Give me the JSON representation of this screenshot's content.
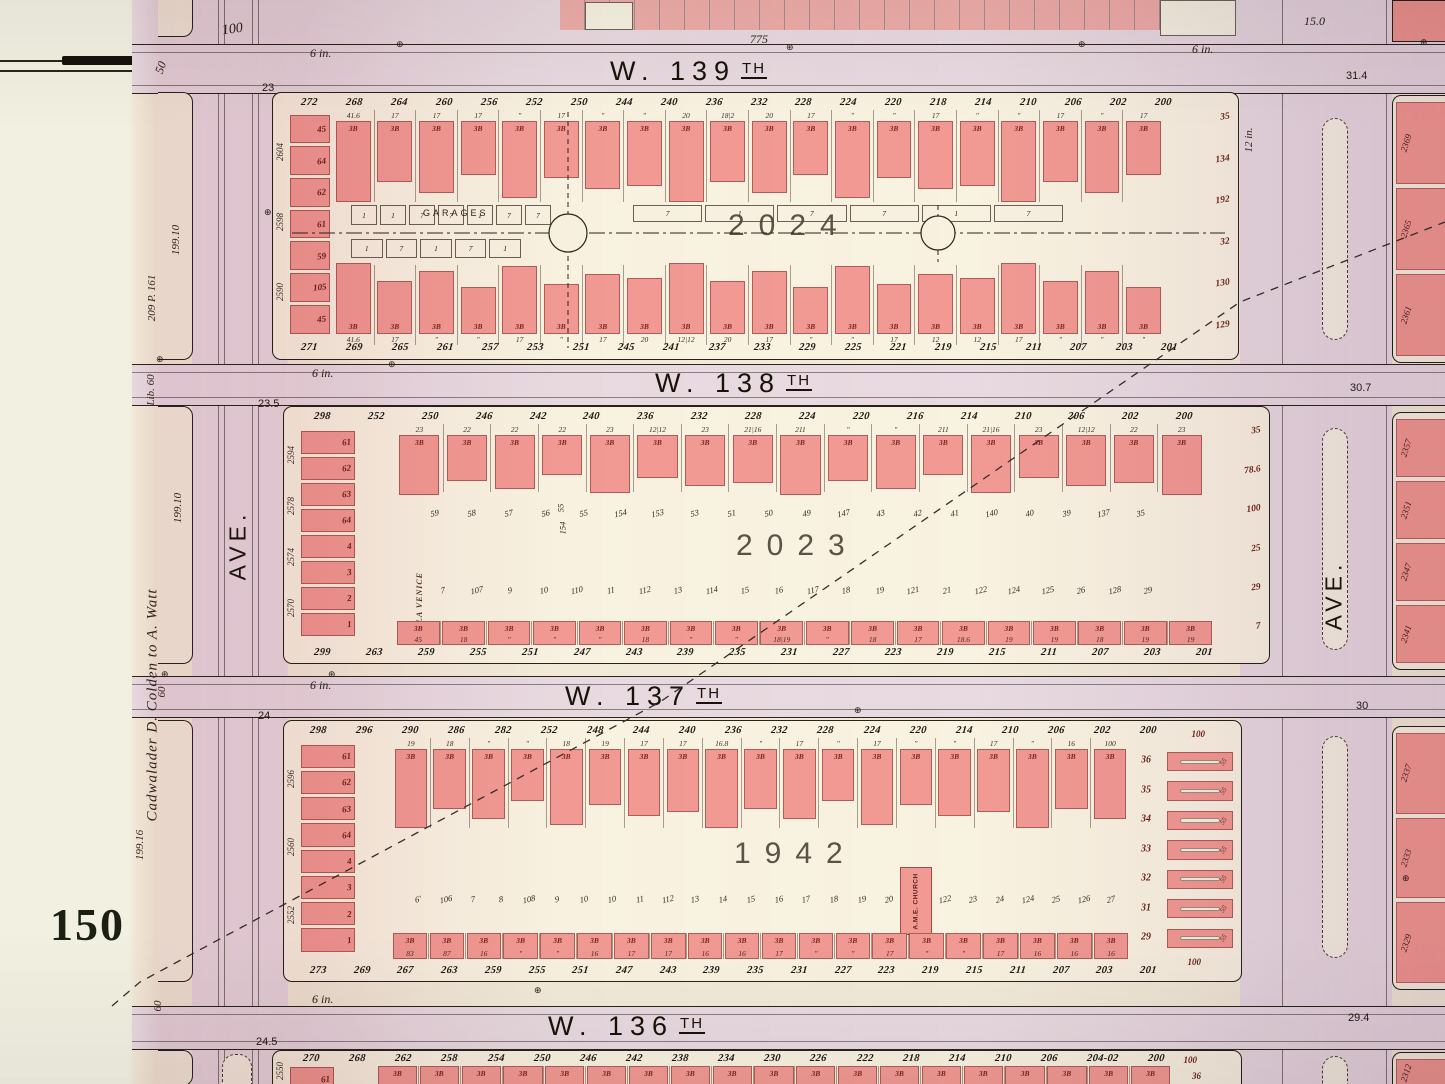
{
  "plate": {
    "number": "150"
  },
  "symbols": {
    "benchmark": "⊕"
  },
  "labels": {
    "six_inch": "6 in.",
    "twelve_inch": "12 in."
  },
  "colors": {
    "lot_pink": "#f29a94",
    "paper": "#f3ecda",
    "street_tint": "#e9dbe2",
    "ink": "#27221a",
    "red_ink": "#79271f"
  },
  "top_margin": {
    "left_width": "100",
    "street_width": "775",
    "right_width": "15.0",
    "corner_lot": "50"
  },
  "edge_depths": {
    "left": [
      "23",
      "23.5",
      "24",
      "24.5"
    ],
    "right": [
      "31.4",
      "30.7",
      "30",
      "29.4"
    ]
  },
  "left_margin": {
    "dim_a": "199.10",
    "ref": "209 P. 161",
    "lib": "Lib. 60",
    "deed": "Cadwalader D. Colden to A. Watt",
    "dim_b": "199.10",
    "dim_c": "60",
    "dim_d": "199.16",
    "dim_e": "60"
  },
  "avenues": {
    "left": {
      "label": "AVE."
    },
    "right": {
      "label": "AVE."
    }
  },
  "streets": [
    {
      "name": "W. 139",
      "suffix": "TH"
    },
    {
      "name": "W. 138",
      "suffix": "TH"
    },
    {
      "name": "W. 137",
      "suffix": "TH"
    },
    {
      "name": "W. 136",
      "suffix": "TH"
    }
  ],
  "blocks": [
    {
      "id": "block-2024",
      "number": "2024",
      "garages_label": "GARAGES",
      "units": "3B",
      "top_addresses": [
        "272",
        "268",
        "264",
        "260",
        "256",
        "252",
        "250",
        "244",
        "240",
        "236",
        "232",
        "228",
        "224",
        "220",
        "218",
        "214",
        "210",
        "206",
        "202",
        "200"
      ],
      "top_frontages": [
        "41.6",
        "17",
        "17",
        "17",
        "″",
        "17",
        "″",
        "″",
        "20",
        "18|2",
        "20",
        "17",
        "″",
        "″",
        "17",
        "″",
        "″",
        "17",
        "″",
        "17"
      ],
      "bottom_addresses": [
        "271",
        "269",
        "265",
        "261",
        "257",
        "253",
        "251",
        "245",
        "241",
        "237",
        "233",
        "229",
        "225",
        "221",
        "219",
        "215",
        "211",
        "207",
        "203",
        "201"
      ],
      "bottom_frontages": [
        "41.6",
        "17",
        "″",
        "″",
        "17",
        "″",
        "17",
        "20",
        "12|12",
        "20",
        "17",
        "″",
        "″",
        "17",
        "12",
        "12",
        "17",
        "″",
        "″",
        "″"
      ],
      "west_parcels": [
        "2604",
        "2598",
        "2590"
      ],
      "west_lots": [
        "45",
        "64",
        "62",
        "61",
        "59",
        "105",
        "45"
      ],
      "east_labels": [
        "35",
        "134",
        "192",
        "32",
        "130",
        "129"
      ],
      "court_boxes_top": [
        "1",
        "1",
        "7",
        "7",
        "1",
        "7",
        "7"
      ],
      "court_boxes_bottom": [
        "1",
        "7",
        "1",
        "7",
        "1"
      ],
      "court_notches": [
        "7",
        "1",
        "7",
        "7",
        "1",
        "7"
      ]
    },
    {
      "id": "block-2023",
      "number": "2023",
      "venice_label": "LA VENICE",
      "units": "3B",
      "depth_labels": [
        "55",
        "154"
      ],
      "top_addresses": [
        "298",
        "252",
        "250",
        "246",
        "242",
        "240",
        "236",
        "232",
        "228",
        "224",
        "220",
        "216",
        "214",
        "210",
        "206",
        "202",
        "200"
      ],
      "top_frontages": [
        "23",
        "22",
        "22",
        "22",
        "23",
        "12|12",
        "23",
        "21|16",
        "211",
        "″",
        "″",
        "211",
        "21|16",
        "23",
        "12|12",
        "22",
        "23"
      ],
      "mid_upper": [
        "59",
        "58",
        "57",
        "56",
        "55",
        "154",
        "153",
        "53",
        "51",
        "50",
        "49",
        "147",
        "43",
        "42",
        "41",
        "140",
        "40",
        "39",
        "137",
        "35"
      ],
      "mid_lower": [
        "7",
        "107",
        "9",
        "10",
        "110",
        "11",
        "112",
        "13",
        "114",
        "15",
        "16",
        "117",
        "18",
        "19",
        "121",
        "21",
        "122",
        "124",
        "125",
        "26",
        "128",
        "29"
      ],
      "bottom_addresses": [
        "299",
        "263",
        "259",
        "255",
        "251",
        "247",
        "243",
        "239",
        "235",
        "231",
        "227",
        "223",
        "219",
        "215",
        "211",
        "207",
        "203",
        "201"
      ],
      "bottom_frontages": [
        "45",
        "18",
        "″",
        "″",
        "″",
        "18",
        "″",
        "″",
        "18|19",
        "″",
        "18",
        "17",
        "18.6",
        "19",
        "19",
        "18",
        "19",
        "19"
      ],
      "bottom_band": true,
      "west_parcels": [
        "2594",
        "2578",
        "2574",
        "2570"
      ],
      "west_lots": [
        "61",
        "62",
        "63",
        "64",
        "4",
        "3",
        "2",
        "1"
      ],
      "east_labels": [
        "35",
        "78.6",
        "100",
        "25",
        "29",
        "7"
      ]
    },
    {
      "id": "block-1942",
      "number": "1942",
      "church_label": "A.M.E. CHURCH",
      "units": "3B",
      "east_depth": "55",
      "east_width": "100",
      "top_addresses": [
        "298",
        "296",
        "290",
        "286",
        "282",
        "252",
        "248",
        "244",
        "240",
        "236",
        "232",
        "228",
        "224",
        "220",
        "214",
        "210",
        "206",
        "202",
        "200"
      ],
      "top_frontages": [
        "19",
        "18",
        "″",
        "″",
        "18",
        "19",
        "17",
        "17",
        "16.8",
        "″",
        "17",
        "″",
        "17",
        "″",
        "″",
        "17",
        "″",
        "16",
        "100"
      ],
      "mid_upper": [
        "6'",
        "106",
        "7",
        "8",
        "108",
        "9",
        "10",
        "10",
        "11",
        "112",
        "13",
        "14",
        "15",
        "16",
        "17",
        "18",
        "19",
        "20",
        "21",
        "122",
        "23",
        "24",
        "124",
        "25",
        "126",
        "27"
      ],
      "bottom_addresses": [
        "273",
        "269",
        "267",
        "263",
        "259",
        "255",
        "251",
        "247",
        "243",
        "239",
        "235",
        "231",
        "227",
        "223",
        "219",
        "215",
        "211",
        "207",
        "203",
        "201"
      ],
      "bottom_frontages": [
        "83",
        "87",
        "16",
        "″",
        "″",
        "16",
        "17",
        "17",
        "16",
        "16",
        "17",
        "″",
        "″",
        "17",
        "″",
        "″",
        "17",
        "16",
        "16",
        "16"
      ],
      "bottom_band": true,
      "west_parcels": [
        "2596",
        "2560",
        "2552"
      ],
      "west_lots": [
        "61",
        "62",
        "63",
        "64",
        "4",
        "3",
        "2",
        "1"
      ],
      "east_lots": [
        "36",
        "35",
        "34",
        "33",
        "32",
        "31",
        "29"
      ]
    },
    {
      "id": "block-1941",
      "number": "",
      "units": "3B",
      "east_width": "100",
      "east_lots": [
        "36"
      ],
      "top_addresses": [
        "270",
        "268",
        "262",
        "258",
        "254",
        "250",
        "246",
        "242",
        "238",
        "234",
        "230",
        "226",
        "222",
        "218",
        "214",
        "210",
        "206",
        "204-02",
        "200"
      ],
      "top_frontages": [
        "100",
        "16.0",
        "16.8",
        "17.6",
        "17.6",
        "16.8",
        "″",
        "″",
        "16.8",
        "17.6",
        "16.8",
        "″",
        "″",
        "16.8",
        "17.6",
        "16.8",
        "17.6",
        "16.8",
        "100"
      ],
      "top_band": true,
      "west_parcels": [
        "2550"
      ],
      "west_lots": [
        "61"
      ]
    }
  ],
  "right_blocks": [
    {
      "parcels": [
        "2369",
        "2365",
        "2361"
      ]
    },
    {
      "parcels": [
        "2357",
        "2351",
        "2347",
        "2341"
      ]
    },
    {
      "parcels": [
        "2337",
        "2333",
        "2329"
      ]
    },
    {
      "parcels": [
        "2312"
      ]
    }
  ]
}
